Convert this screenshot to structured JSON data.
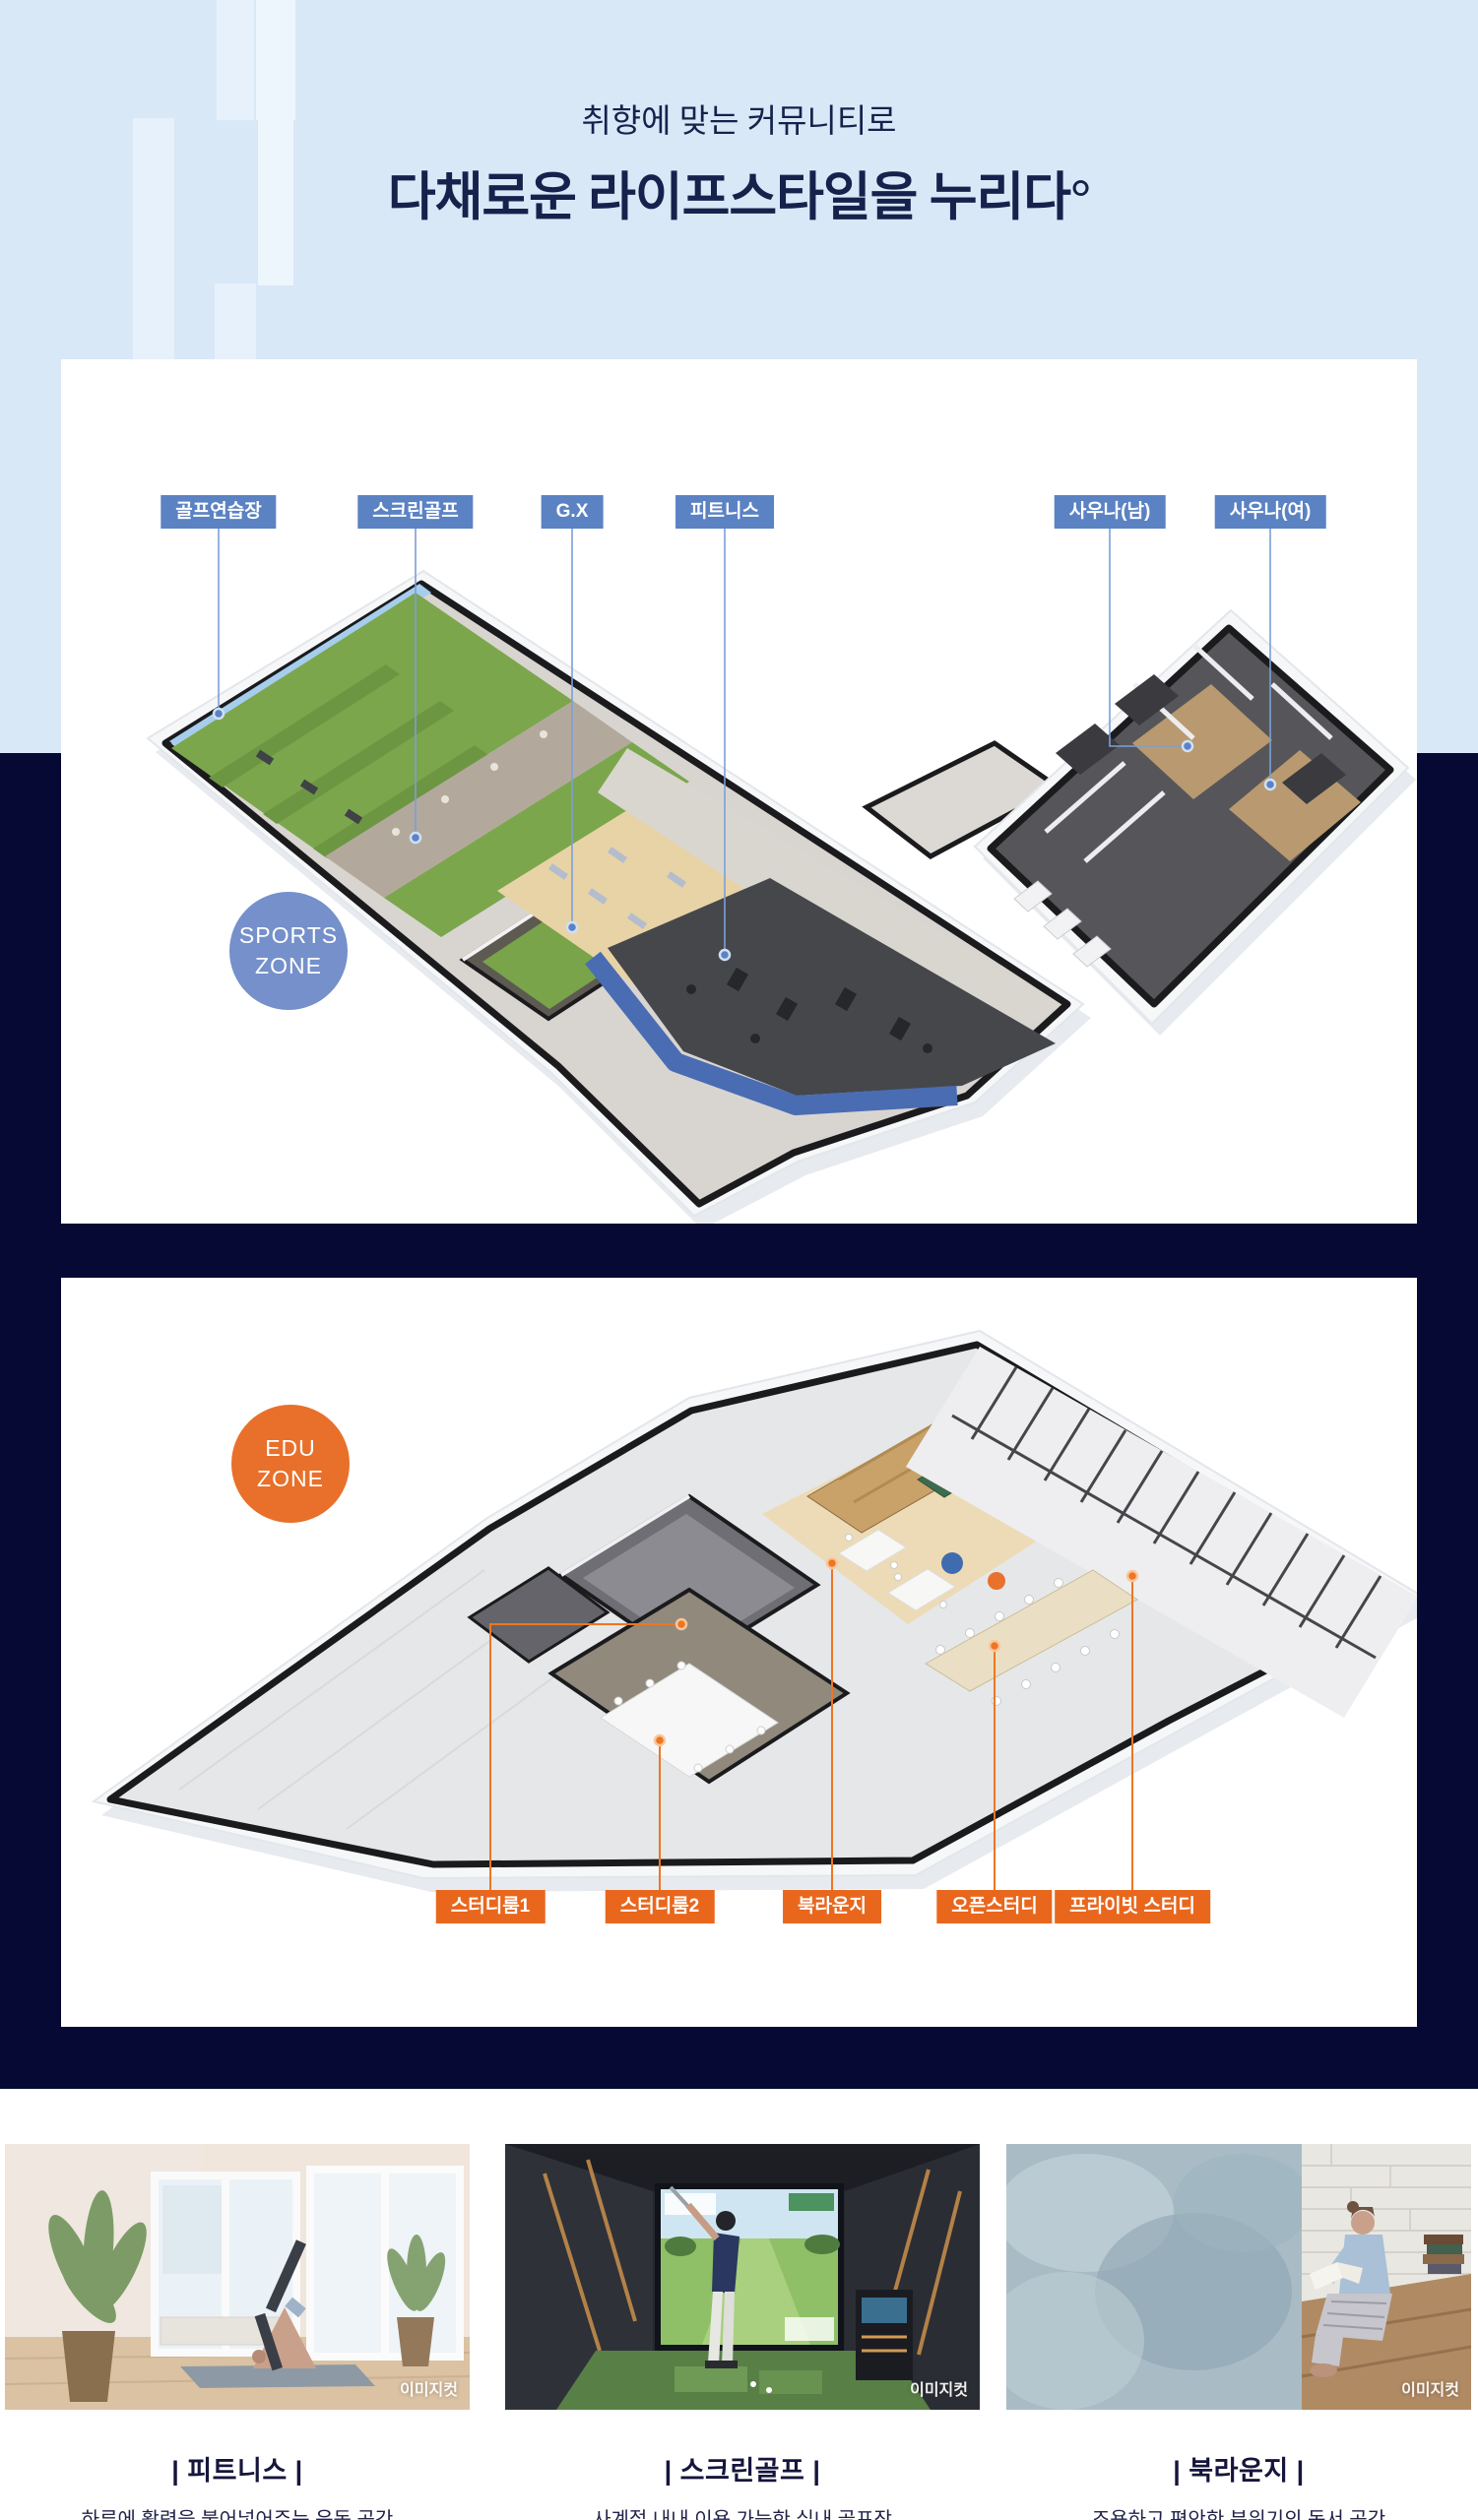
{
  "palette": {
    "header_bg": "#d9e8f7",
    "navy_bg": "#060934",
    "label_blue": "#5b82c3",
    "label_orange": "#e8671d",
    "sports_badge": "#7590ca",
    "edu_badge": "#e8702b",
    "leader_blue": "#7b9fd8",
    "leader_orange": "#ee7622"
  },
  "header": {
    "subtitle": "취향에 맞는 커뮤니티로",
    "title": "다채로운 라이프스타일을 누리다°"
  },
  "sports_zone": {
    "badge_line1": "SPORTS",
    "badge_line2": "ZONE",
    "labels": [
      {
        "text": "골프연습장"
      },
      {
        "text": "스크린골프"
      },
      {
        "text": "G.X"
      },
      {
        "text": "피트니스"
      },
      {
        "text": "사우나(남)"
      },
      {
        "text": "사우나(여)"
      }
    ]
  },
  "edu_zone": {
    "badge_line1": "EDU",
    "badge_line2": "ZONE",
    "labels": [
      {
        "text": "스터디룸1"
      },
      {
        "text": "스터디룸2"
      },
      {
        "text": "북라운지"
      },
      {
        "text": "오픈스터디"
      },
      {
        "text": "프라이빗 스터디"
      }
    ]
  },
  "photo_cards": [
    {
      "caption": "| 피트니스 |",
      "description": "하루에 활력을 불어넣어주는 운동 공간",
      "watermark": "이미지컷"
    },
    {
      "caption": "| 스크린골프 |",
      "description": "사계절 내내 이용 가능한 실내 골프장",
      "watermark": "이미지컷"
    },
    {
      "caption": "| 북라운지 |",
      "description": "조용하고 편안한 분위기의 독서 공간",
      "watermark": "이미지컷"
    }
  ]
}
